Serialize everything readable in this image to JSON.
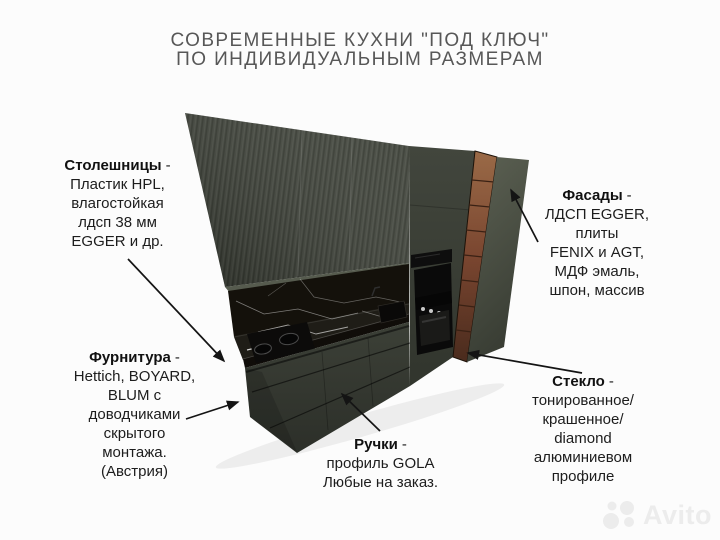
{
  "header": {
    "title_line1": "СОВРЕМЕННЫЕ КУХНИ \"ПОД КЛЮЧ\"",
    "title_line2": "ПО ИНДИВИДУАЛЬНЫМ РАЗМЕРАМ"
  },
  "callouts": {
    "countertops": {
      "name": "Столешницы",
      "sep": "-",
      "lines": [
        "Пластик HPL,",
        "влагостойкая",
        "лдсп 38 мм",
        "EGGER и др."
      ]
    },
    "facades": {
      "name": "Фасады",
      "sep": "-",
      "lines": [
        "ЛДСП EGGER,",
        "плиты",
        "FENIX и AGT,",
        "МДФ эмаль,",
        "шпон, массив"
      ]
    },
    "hardware": {
      "name": "Фурнитура",
      "sep": "-",
      "lines": [
        "Hettich, BOYARD,",
        "BLUM с",
        "доводчиками",
        "скрытого",
        "монтажа.",
        "(Австрия)"
      ]
    },
    "handles": {
      "name": "Ручки",
      "sep": "-",
      "lines": [
        "профиль GOLA",
        "Любые на заказ."
      ]
    },
    "glass": {
      "name": "Стекло",
      "sep": "-",
      "lines": [
        "тонированное/",
        "крашенное/",
        "diamond",
        "алюминиевом",
        "профиле"
      ]
    }
  },
  "watermark": {
    "brand": "Avito"
  },
  "colors": {
    "background": "#fcfcfc",
    "title_text": "#575757",
    "body_text": "#1d1d1d",
    "cabinet_dark_olive": "#3f433a",
    "cabinet_light_olive": "#5c6153",
    "wood_column": "#8a5a3a",
    "marble_black": "#14110b",
    "arrow_black": "#141414",
    "watermark_gray": "#ececec"
  }
}
